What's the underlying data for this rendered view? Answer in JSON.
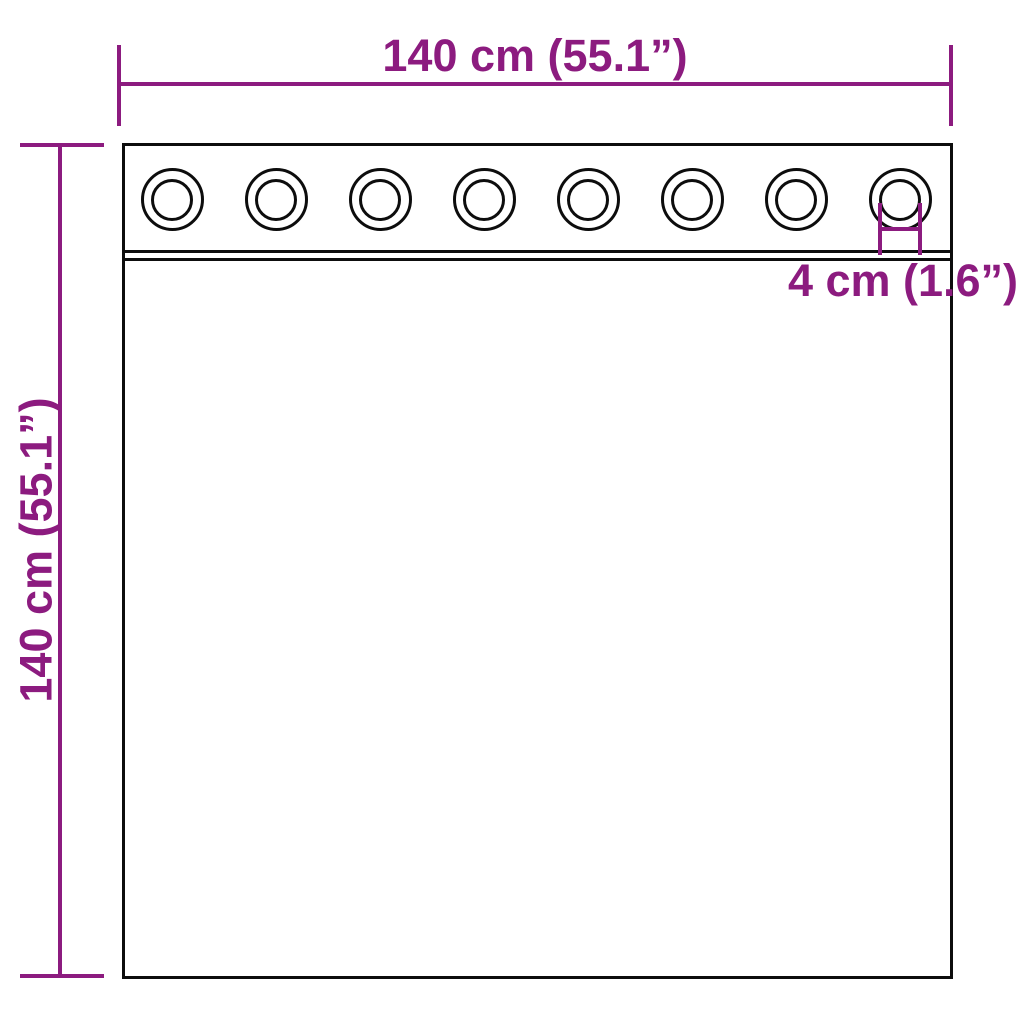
{
  "diagram": {
    "type": "product-dimension-diagram",
    "subject": "curtain with grommets",
    "labels": {
      "width": "140 cm (55.1”)",
      "height": "140 cm (55.1”)",
      "grommet_diameter": "4 cm (1.6”)"
    },
    "grommets": {
      "count": 8,
      "first_center_x": 172,
      "spacing": 104,
      "center_y": 199
    },
    "colors": {
      "dimension": "#8C1B7F",
      "outline": "#0d0d0d",
      "background": "#FFFFFF"
    }
  }
}
